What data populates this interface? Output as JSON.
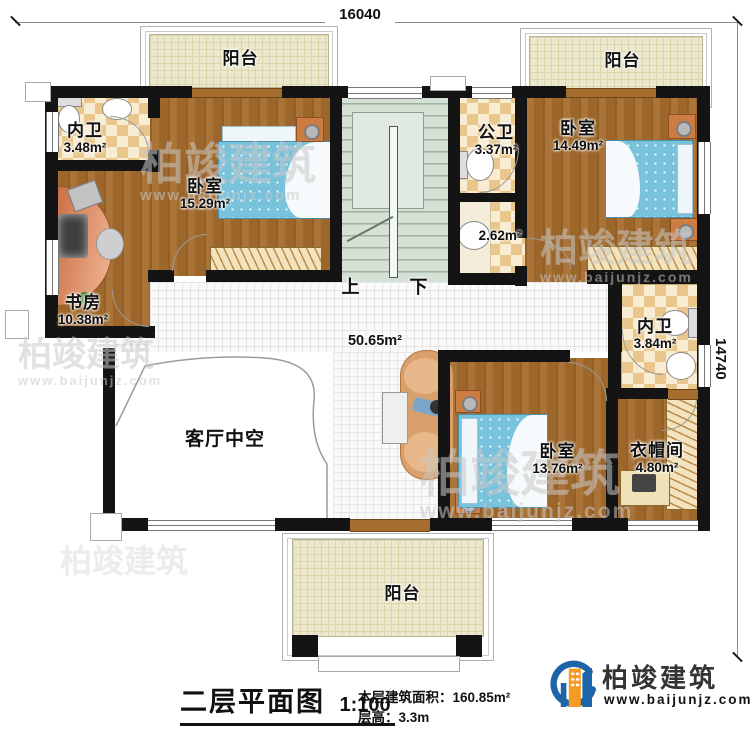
{
  "dimensions": {
    "width_mm": "16040",
    "height_mm": "14740"
  },
  "rooms": {
    "balcony_top_left": {
      "label": "阳台"
    },
    "balcony_top_right": {
      "label": "阳台"
    },
    "balcony_bottom": {
      "label": "阳台"
    },
    "bath_top_left": {
      "label": "内卫",
      "area": "3.48m²"
    },
    "bedroom_top_left": {
      "label": "卧室",
      "area": "15.29m²"
    },
    "study": {
      "label": "书房",
      "area": "10.38m²"
    },
    "public_bath": {
      "label": "公卫",
      "area": "3.37m²"
    },
    "washroom": {
      "area": "2.62m²"
    },
    "bedroom_top_right": {
      "label": "卧室",
      "area": "14.49m²"
    },
    "bath_right": {
      "label": "内卫",
      "area": "3.84m²"
    },
    "cloakroom": {
      "label": "衣帽间",
      "area": "4.80m²"
    },
    "bedroom_bottom": {
      "label": "卧室",
      "area": "13.76m²"
    },
    "hall": {
      "area": "50.65m²"
    },
    "living_void": {
      "label": "客厅中空"
    }
  },
  "stairs": {
    "up_label": "上",
    "down_label": "下"
  },
  "titleblock": {
    "title": "二层平面图",
    "scale": "1:100",
    "floor_area": "本层建筑面积：160.85m²",
    "floor_height": "层高：3.3m"
  },
  "brand": {
    "name": "柏竣建筑",
    "website": "www.baijunjz.com"
  },
  "watermark": {
    "name": "柏竣建筑",
    "website": "www.baijunjz.com"
  }
}
